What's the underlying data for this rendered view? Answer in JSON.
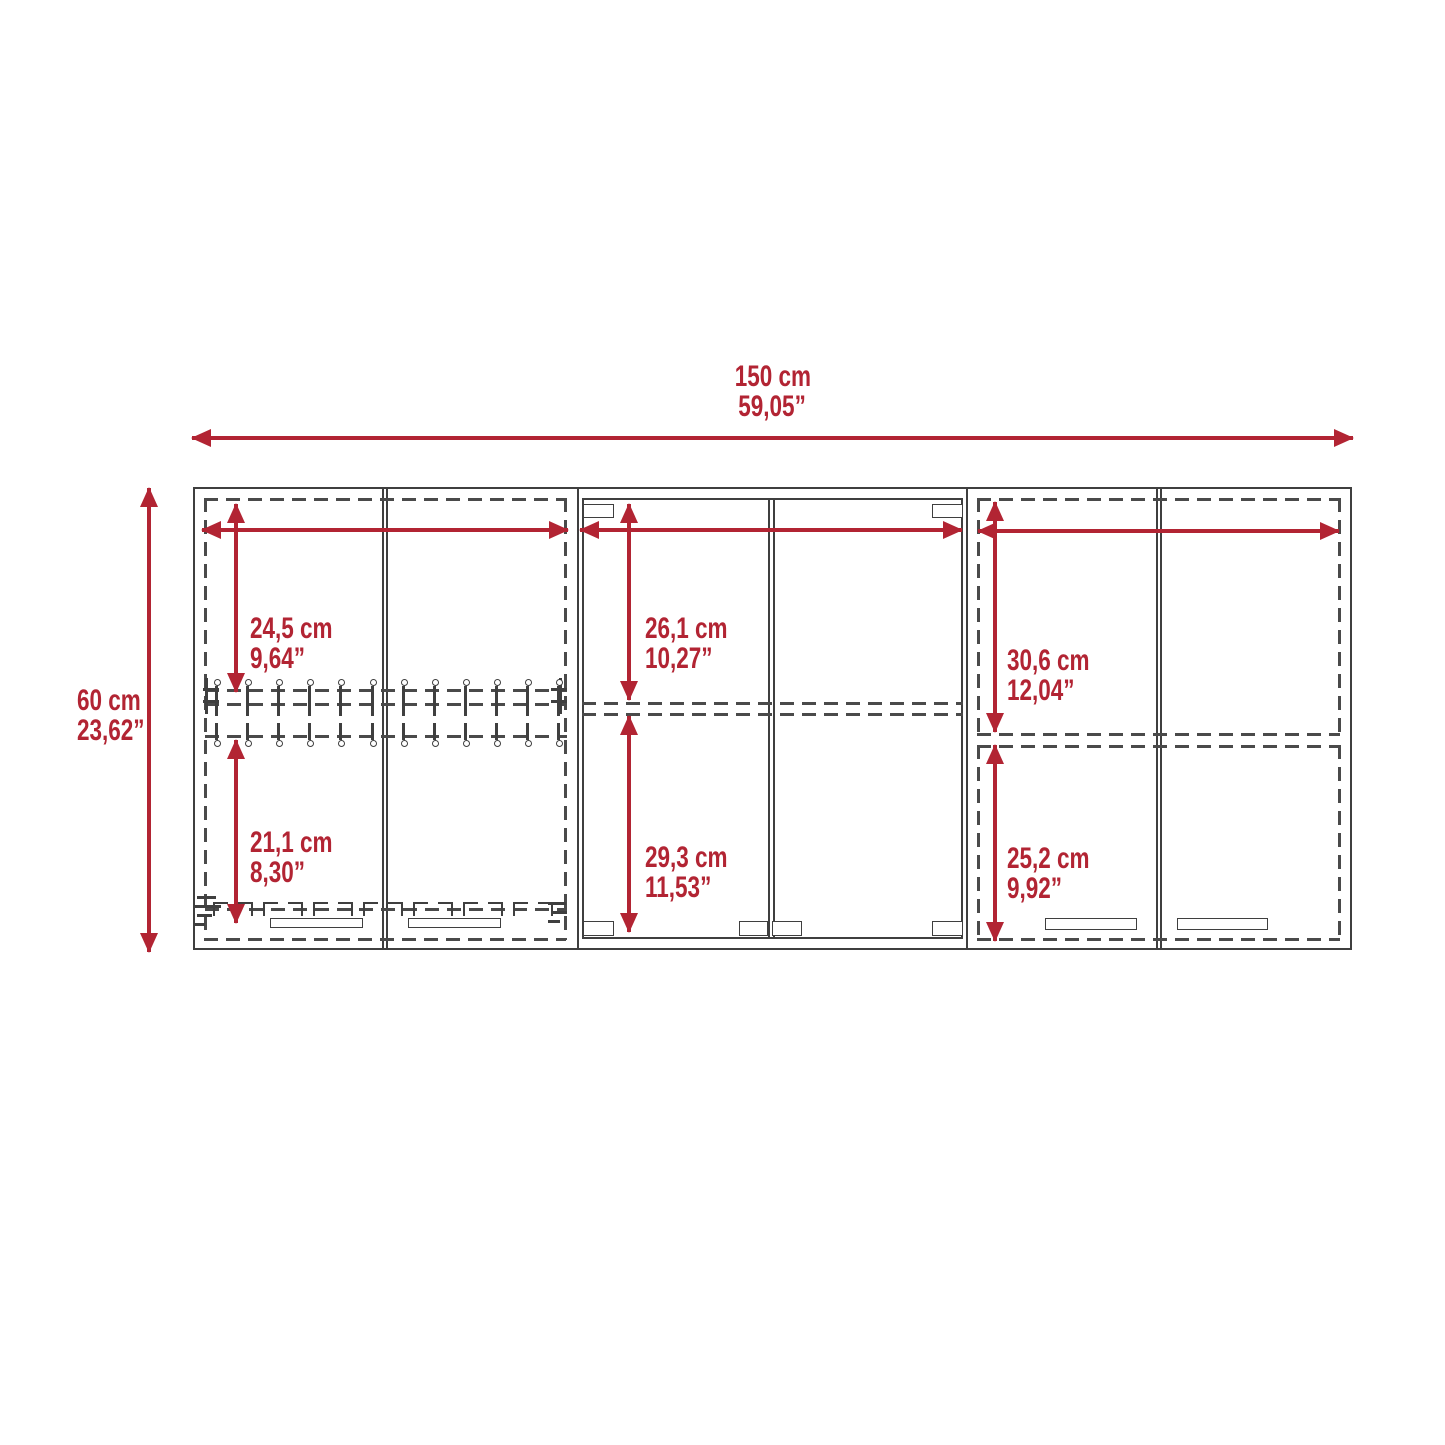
{
  "colors": {
    "accent": "#b22433",
    "line": "#3f3f3f",
    "dash": "#4a4a4a"
  },
  "diagram": {
    "type": "furniture-dimension-drawing",
    "overall": {
      "width": {
        "cm": "150 cm",
        "inch": "59,05”"
      },
      "height": {
        "cm": "60 cm",
        "inch": "23,62”"
      }
    },
    "sections": {
      "left_top": {
        "cm": "24,5 cm",
        "inch": "9,64”"
      },
      "left_bottom": {
        "cm": "21,1 cm",
        "inch": "8,30”"
      },
      "center_top": {
        "cm": "26,1 cm",
        "inch": "10,27”"
      },
      "center_bottom": {
        "cm": "29,3 cm",
        "inch": "11,53”"
      },
      "right_top": {
        "cm": "30,6 cm",
        "inch": "12,04”"
      },
      "right_bottom": {
        "cm": "25,2 cm",
        "inch": "9,92”"
      }
    }
  }
}
